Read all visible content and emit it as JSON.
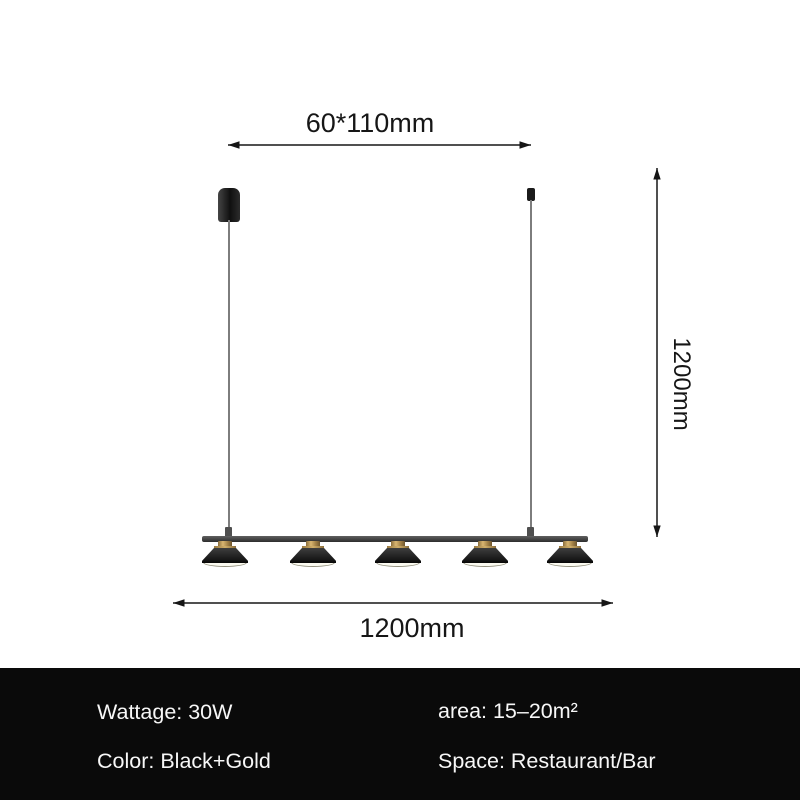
{
  "diagram": {
    "canopy_dim_label": "60*110mm",
    "length_dim_label": "1200mm",
    "height_dim_label": "1200mm",
    "fixture": {
      "head_count": 5,
      "style": "linear pendant bar with cylinder canopy, two suspension wires, five cone shades"
    },
    "colors": {
      "line": "#161616",
      "fixture_black": "#1b1b1b",
      "accent_gold": "#c9a45c",
      "diffuser_white": "#fbfaf0"
    }
  },
  "specs": {
    "wattage": "Wattage: 30W",
    "area": "area: 15–20m²",
    "color": "Color: Black+Gold",
    "space": "Space: Restaurant/Bar",
    "background": "#0a0a0a",
    "text_color": "#f7f7f7"
  }
}
